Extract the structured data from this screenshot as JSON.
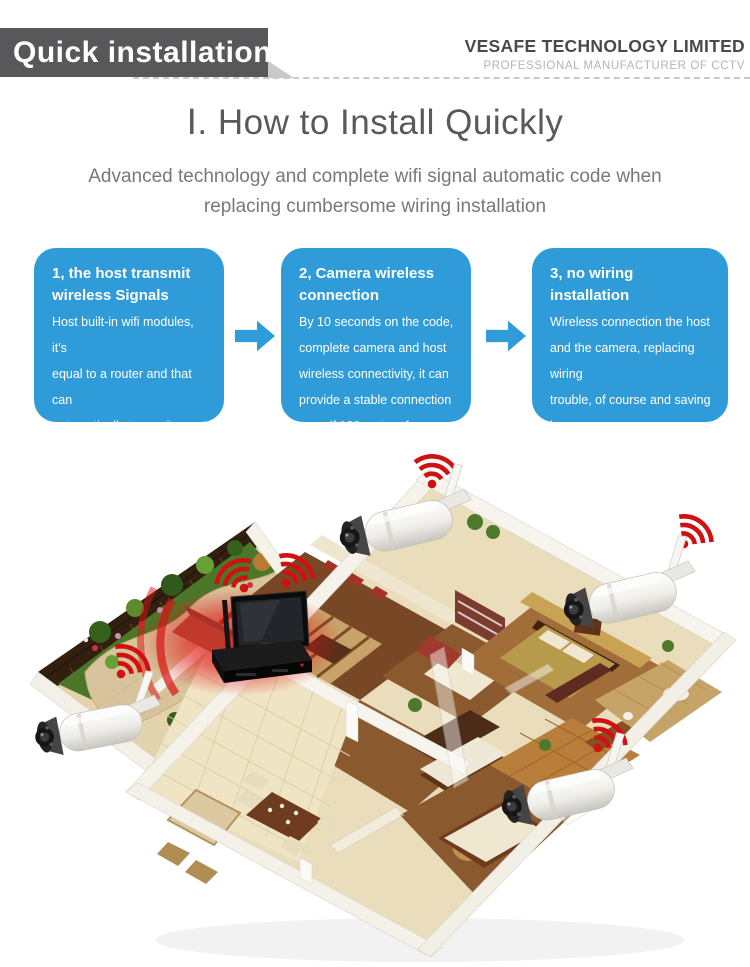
{
  "header": {
    "banner_label": "Quick installation",
    "company_name": "VESAFE TECHNOLOGY LIMITED",
    "company_tagline": "PROFESSIONAL MANUFACTURER OF CCTV"
  },
  "intro": {
    "title": "Ⅰ. How to Install Quickly",
    "subtitle": "Advanced technology and complete wifi signal automatic code when\nreplacing cumbersome wiring installation"
  },
  "steps": [
    {
      "title": "1, the host transmit\nwireless Signals",
      "body": "Host built-in wifi modules, it's\nequal to a router and that can\nautomatically transmit wireless\nsignals to the camera"
    },
    {
      "title": "2, Camera wireless\nconnection",
      "body": "By 10 seconds on the code,\ncomplete camera and host\nwireless connectivity, it can\n provide a stable connection\neven if 100 meters far away"
    },
    {
      "title": "3, no wiring installation",
      "body": "Wireless connection the host\nand the camera, replacing wiring\ntrouble, of course and saving i\nnstallation time."
    }
  ],
  "icons": {
    "step_arrow": "right-arrow",
    "camera_signal": "wifi-signal"
  },
  "colors": {
    "accent_blue": "#2F9CD9",
    "signal_red": "#D01111",
    "banner_gray": "#58585A"
  }
}
